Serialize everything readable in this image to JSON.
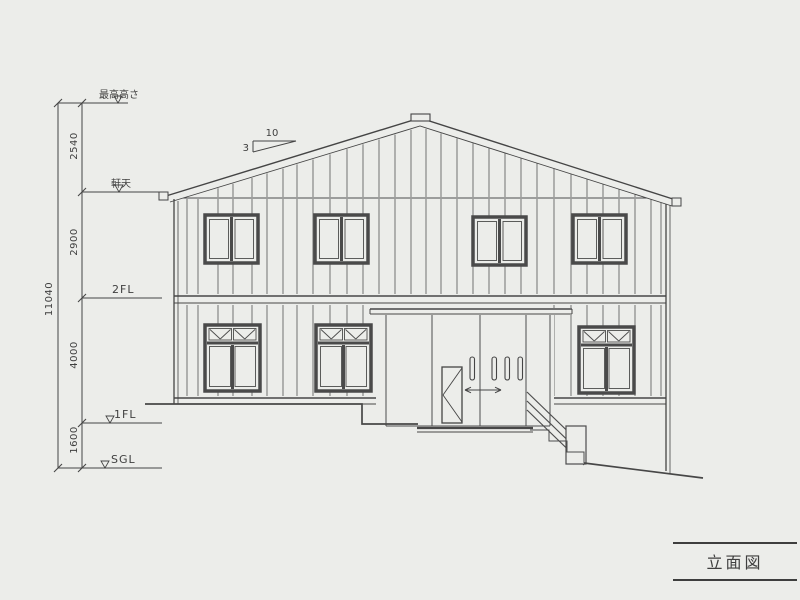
{
  "page": {
    "background": "#ecedea",
    "ink": "#454545"
  },
  "annotations": {
    "levels": [
      {
        "label": "最高高さ"
      },
      {
        "label": "軒天"
      },
      {
        "label": "2FL"
      },
      {
        "label": "1FL"
      },
      {
        "label": "SGL"
      }
    ],
    "dims": {
      "overall": "11040",
      "segments": [
        "2540",
        "2900",
        "4000",
        "1600"
      ]
    },
    "slope": {
      "run": "10",
      "rise": "3"
    }
  },
  "title_block": {
    "label": "立面図"
  }
}
